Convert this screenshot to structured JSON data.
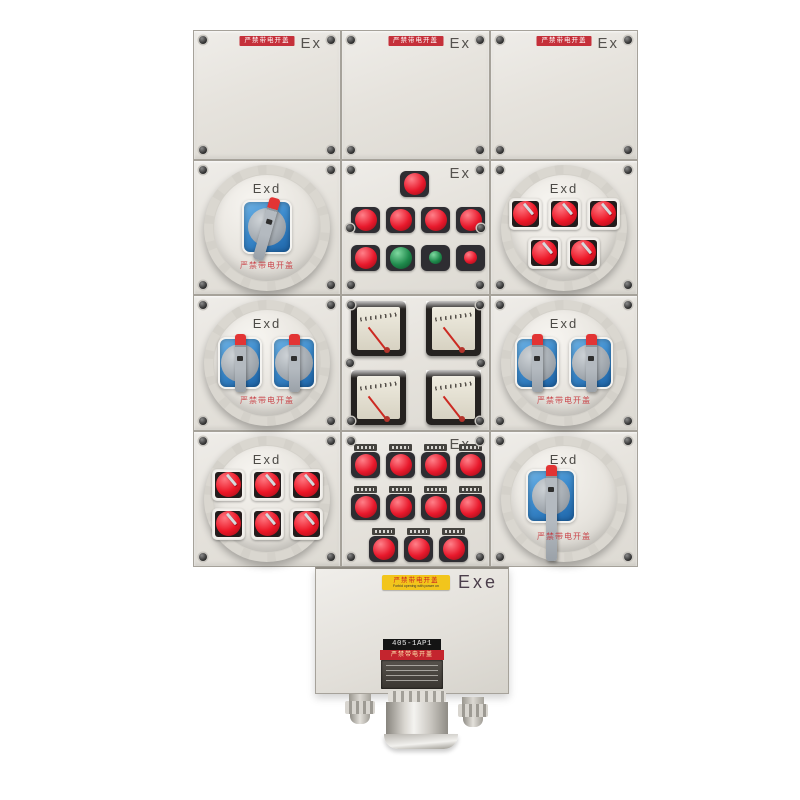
{
  "product": "explosion-proof power distribution control box (photo)",
  "markings": {
    "ex": "Ex",
    "exd": "Exd",
    "exe": "Exe"
  },
  "door_label": {
    "text_cn": "严禁带电开盖"
  },
  "round_cover_warning": {
    "text_cn": "严禁带电开盖"
  },
  "bottom_box": {
    "warning_sticker": {
      "line1_cn": "严禁带电开盖",
      "line2_en": "Forbid opening with power on"
    },
    "nameplate": {
      "model": "405-1AP1",
      "warning_cn": "严禁带电开盖"
    }
  },
  "modules": [
    {
      "position": "top-row",
      "type": "blank doors x3",
      "marking": "Ex",
      "label": "严禁带电开盖"
    },
    {
      "position": "row1-left",
      "type": "round-cover",
      "marking": "Exd",
      "controls": "1 rotary switch (blue window, tilted handle)"
    },
    {
      "position": "row1-center",
      "type": "panel",
      "marking": "Ex",
      "controls": "1 large red lamp, 4 red lamps, buttons: red / green / small green / small red"
    },
    {
      "position": "row1-right",
      "type": "round-cover",
      "marking": "Exd",
      "controls": "5 red toggle switches (3+2)"
    },
    {
      "position": "row2-left",
      "type": "round-cover",
      "marking": "Exd",
      "controls": "2 rotary switches"
    },
    {
      "position": "row2-center",
      "type": "panel",
      "marking": "Ex",
      "controls": "4 analog meters (2x2)"
    },
    {
      "position": "row2-right",
      "type": "round-cover",
      "marking": "Exd",
      "controls": "2 rotary switches"
    },
    {
      "position": "row3-left",
      "type": "round-cover",
      "marking": "Exd",
      "controls": "6 red toggle switches (3+3)"
    },
    {
      "position": "row3-center",
      "type": "panel",
      "marking": "Ex",
      "controls": "11 red indicator lamps (4+4+3) with tags"
    },
    {
      "position": "row3-right",
      "type": "round-cover",
      "marking": "Exd",
      "controls": "1 rotary switch with long handle"
    }
  ],
  "colors": {
    "body_gray": "#e8e5e0",
    "seam": "#a6a29a",
    "label_red": "#c5303a",
    "lamp_red": "#e8192c",
    "lamp_green": "#1f8a4c",
    "window_blue": "#2f7fc4",
    "handle_gray": "#9fa6ad",
    "handle_tip_red": "#e23434",
    "warning_yellow": "#f2c51c",
    "exe_text": "#4c3f4c"
  }
}
